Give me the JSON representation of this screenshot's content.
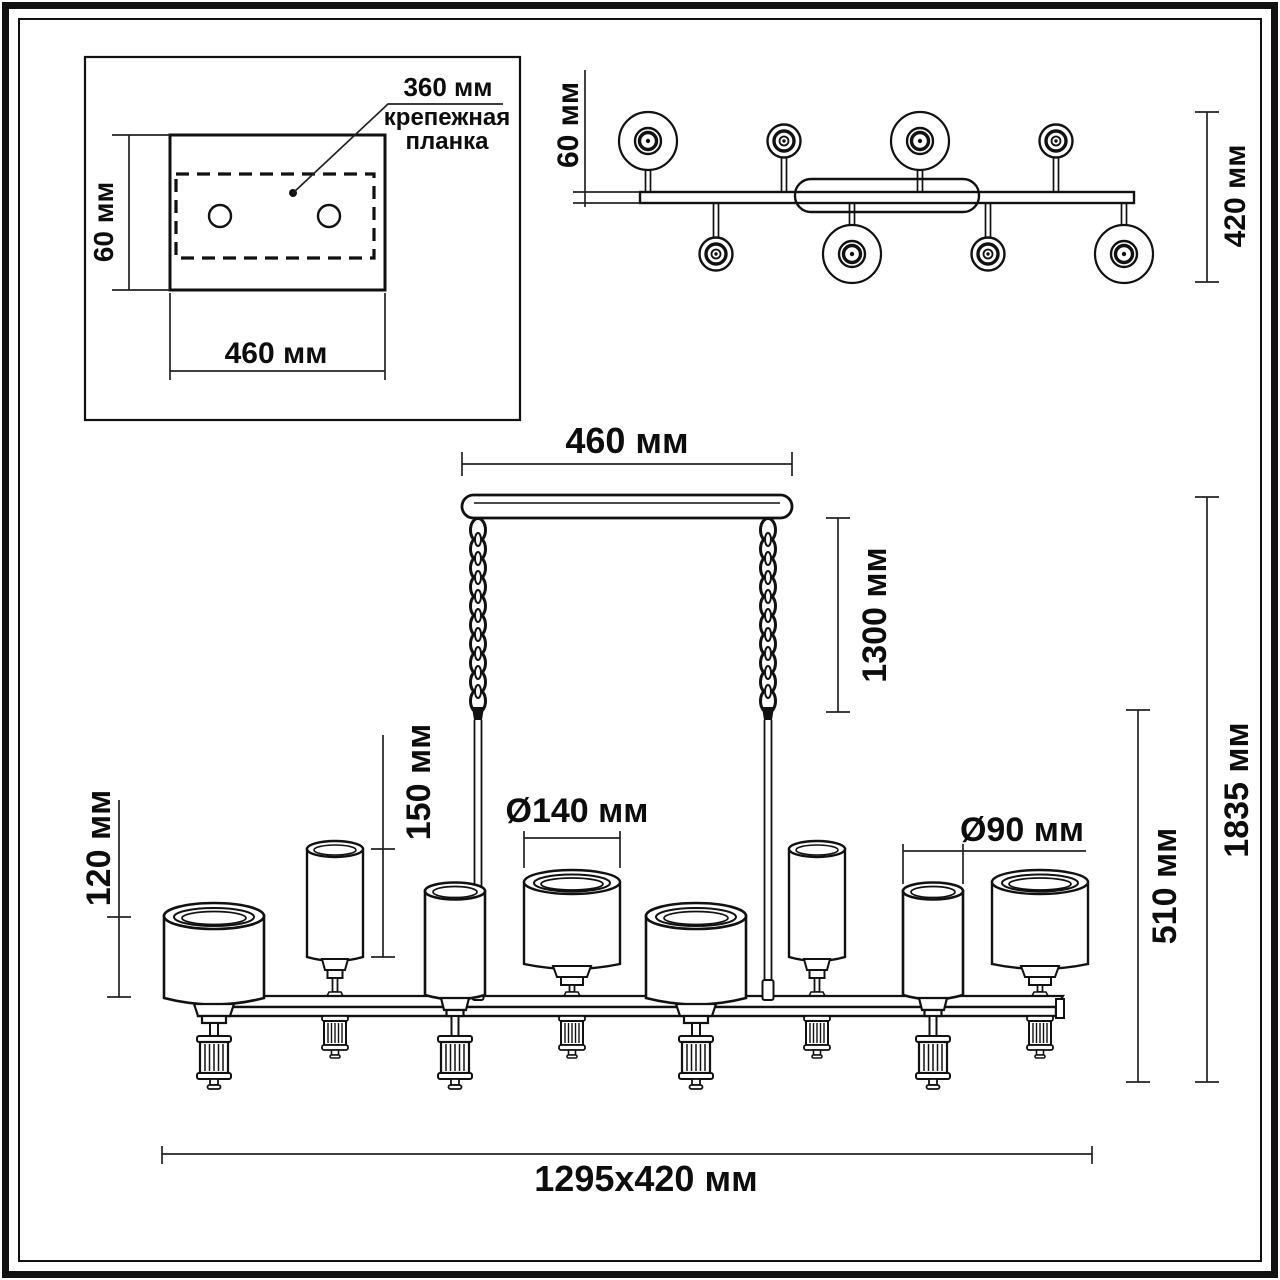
{
  "units": "мм",
  "inset": {
    "bracket_length": "360 мм",
    "bracket_caption_line1": "крепежная",
    "bracket_caption_line2": "планка",
    "plate_height": "60 мм",
    "plate_width": "460 мм"
  },
  "top_view": {
    "bar_depth": "60 мм",
    "overall_depth": "420 мм"
  },
  "front_view": {
    "canopy_width": "460 мм",
    "suspension_length": "1300 мм",
    "small_shade_height": "150 мм",
    "large_shade_height": "120 мм",
    "large_shade_diameter": "Ø140 мм",
    "small_shade_diameter": "Ø90 мм",
    "body_height": "510 мм",
    "overall_height": "1835 мм",
    "overall_footprint": "1295x420 мм"
  },
  "colors": {
    "line": "#111111",
    "background": "#ffffff"
  }
}
